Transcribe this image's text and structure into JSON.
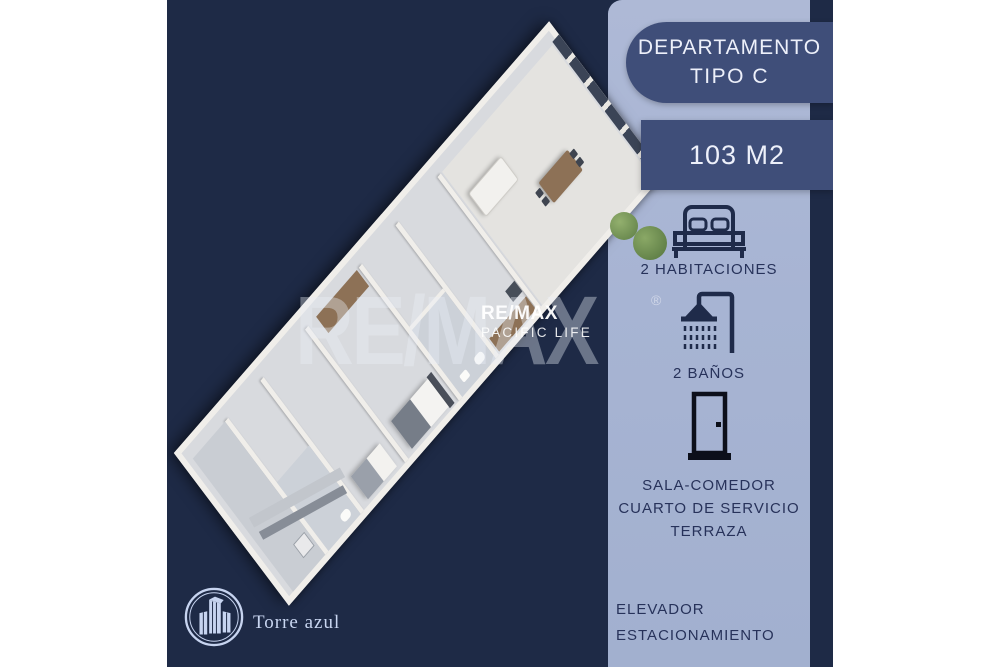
{
  "poster": {
    "background_color": "#1e2a46",
    "panel_color": "#a7b4d3",
    "card_color": "#3f4e79",
    "card_text_color": "#edf0fa",
    "label_text_color": "#27325a",
    "brand_text_color": "#c9d6f1",
    "icon_color": "#1f2b4a"
  },
  "title_card": {
    "line1": "DEPARTAMENTO",
    "line2": "TIPO C"
  },
  "area_card": {
    "value": "103 M2"
  },
  "features": {
    "bedrooms": {
      "icon": "bed-icon",
      "label": "2 HABITACIONES"
    },
    "bathrooms": {
      "icon": "shower-icon",
      "label": "2 BAÑOS"
    },
    "spaces": {
      "icon": "door-icon",
      "lines": [
        "SALA-COMEDOR",
        "CUARTO DE SERVICIO",
        "TERRAZA"
      ]
    }
  },
  "amenities": [
    "ELEVADOR",
    "ESTACIONAMIENTO"
  ],
  "watermark": {
    "big_text": "RE/MAX",
    "registered": "®",
    "small_line1": "RE/MAX",
    "small_line2": "PACIFIC LIFE"
  },
  "brand": {
    "name": "Torre azul"
  }
}
